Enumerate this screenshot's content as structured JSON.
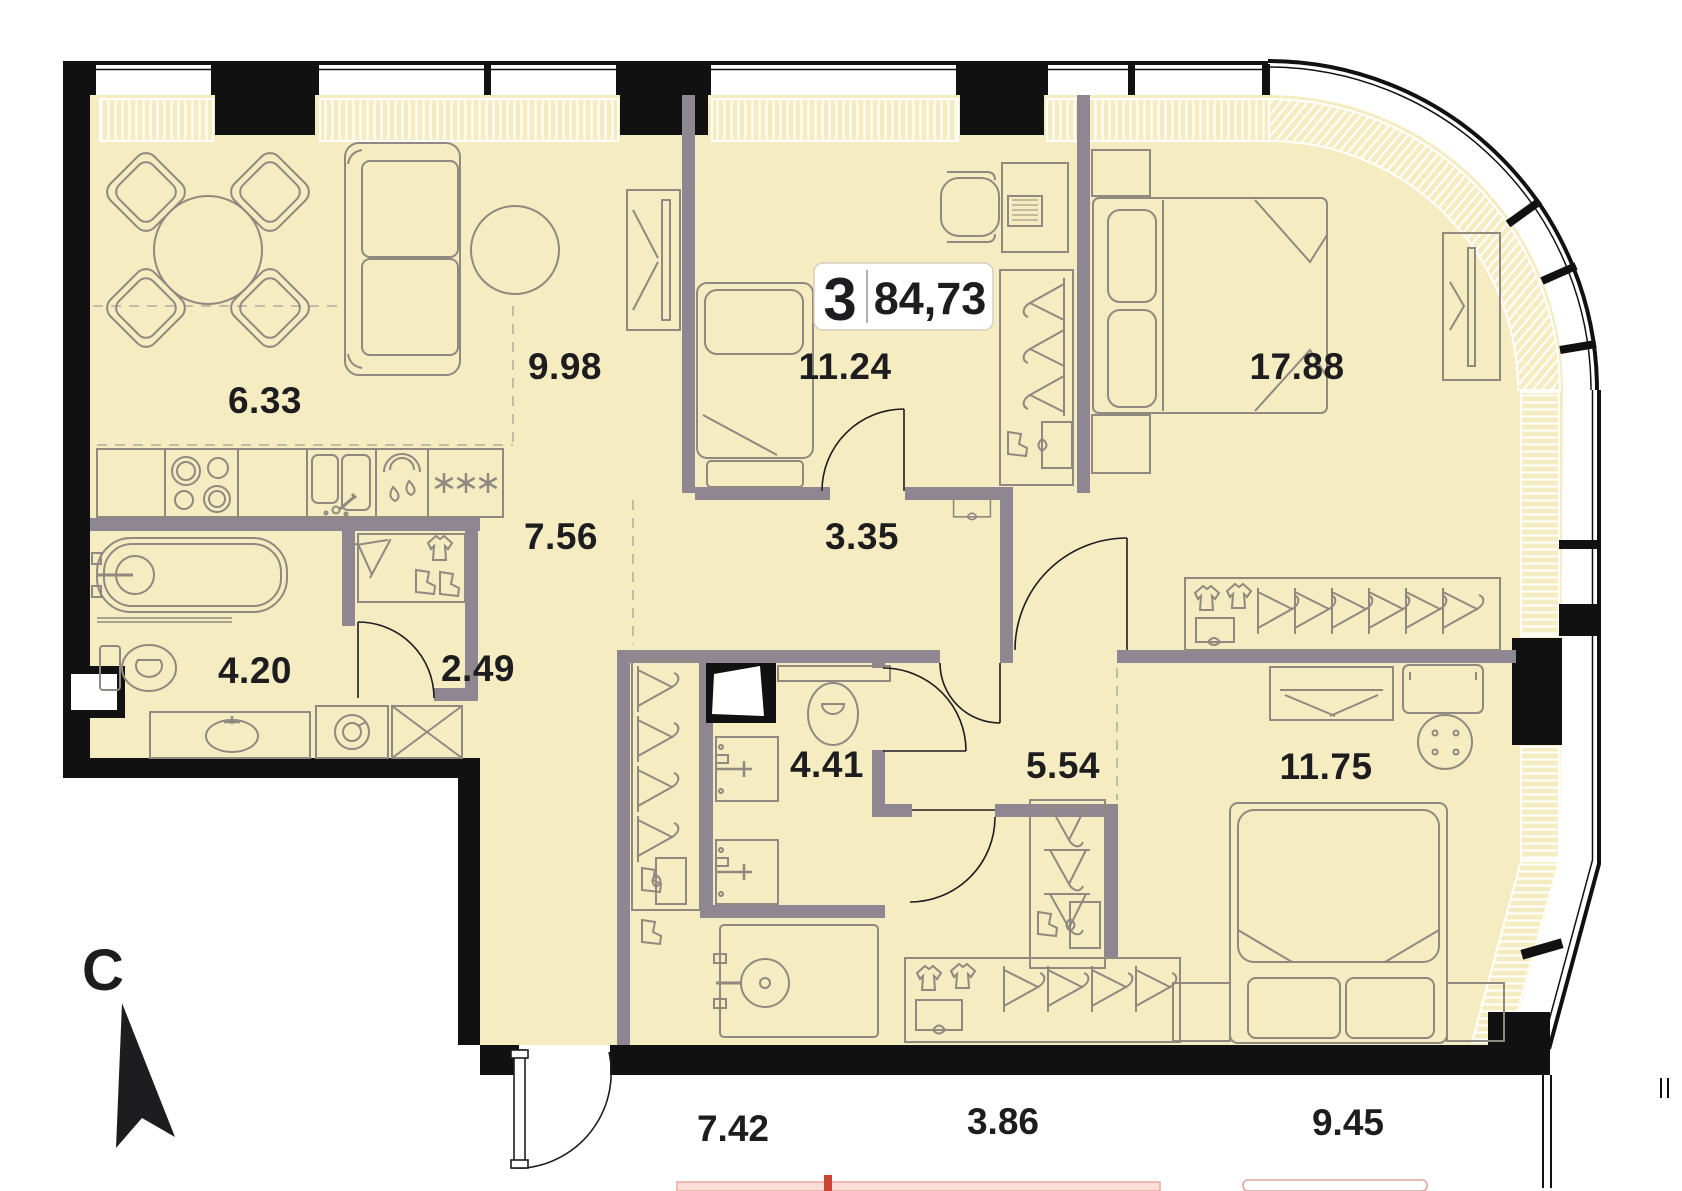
{
  "plan": {
    "title": "apartment-floor-plan",
    "badge": {
      "rooms_count": "3",
      "total_area": "84,73"
    },
    "compass": {
      "letter": "C"
    },
    "rooms": [
      {
        "id": "kitchen-dining",
        "area": "6.33"
      },
      {
        "id": "living-zone",
        "area": "9.98"
      },
      {
        "id": "bedroom-small",
        "area": "11.24"
      },
      {
        "id": "bedroom-master",
        "area": "17.88"
      },
      {
        "id": "entry-hall",
        "area": "7.56"
      },
      {
        "id": "corridor",
        "area": "3.35"
      },
      {
        "id": "bathroom-main",
        "area": "4.20"
      },
      {
        "id": "wardrobe-room",
        "area": "2.49"
      },
      {
        "id": "bathroom-second",
        "area": "4.41"
      },
      {
        "id": "hallway-rear",
        "area": "5.54"
      },
      {
        "id": "bedroom-rear",
        "area": "11.75"
      }
    ],
    "adjacent_areas": [
      {
        "area": "7.42"
      },
      {
        "area": "3.86"
      },
      {
        "area": "9.45"
      }
    ],
    "colors": {
      "floor": "#f5ecc2",
      "interior_wall": "#8e8791",
      "exterior_wall": "#111111",
      "furniture_line": "#8f897f",
      "adjacent_pink": "#fbded8"
    }
  }
}
